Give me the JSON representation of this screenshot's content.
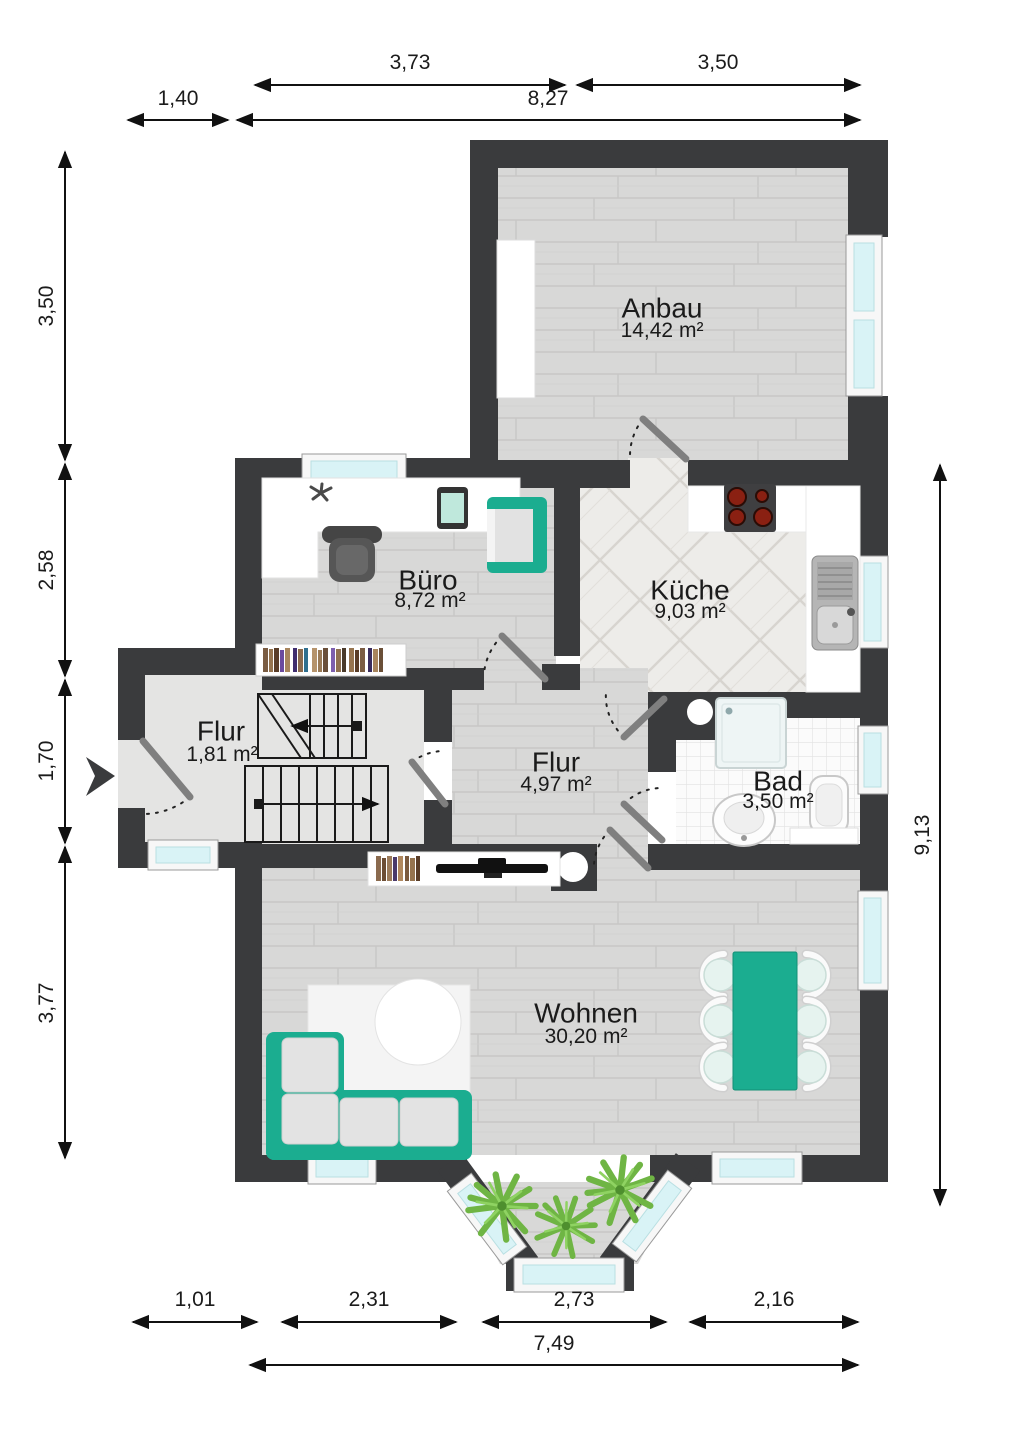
{
  "plan_type": "floor-plan",
  "rooms": {
    "anbau": {
      "name": "Anbau",
      "area": "14,42 m²"
    },
    "buero": {
      "name": "Büro",
      "area": "8,72 m²"
    },
    "kueche": {
      "name": "Küche",
      "area": "9,03 m²"
    },
    "flur_klein": {
      "name": "Flur",
      "area": "1,81 m²"
    },
    "flur": {
      "name": "Flur",
      "area": "4,97 m²"
    },
    "bad": {
      "name": "Bad",
      "area": "3,50 m²"
    },
    "wohnen": {
      "name": "Wohnen",
      "area": "30,20 m²"
    }
  },
  "dimensions": {
    "top_inner": [
      "3,73",
      "3,50"
    ],
    "top_outer": [
      "1,40",
      "8,27"
    ],
    "left": [
      "3,50",
      "2,58",
      "1,70",
      "3,77"
    ],
    "right": [
      "9,13"
    ],
    "bottom_inner": [
      "1,01",
      "2,31",
      "2,73",
      "2,16"
    ],
    "bottom_outer": [
      "7,49"
    ]
  },
  "colors": {
    "wall": "#3A3B3D",
    "accent_teal": "#1BAD90",
    "window_glass": "#D9F3F6",
    "floor_wood": "#D8D8D7",
    "floor_plain": "#E4E4E3",
    "plant_green": "#6FB544"
  }
}
